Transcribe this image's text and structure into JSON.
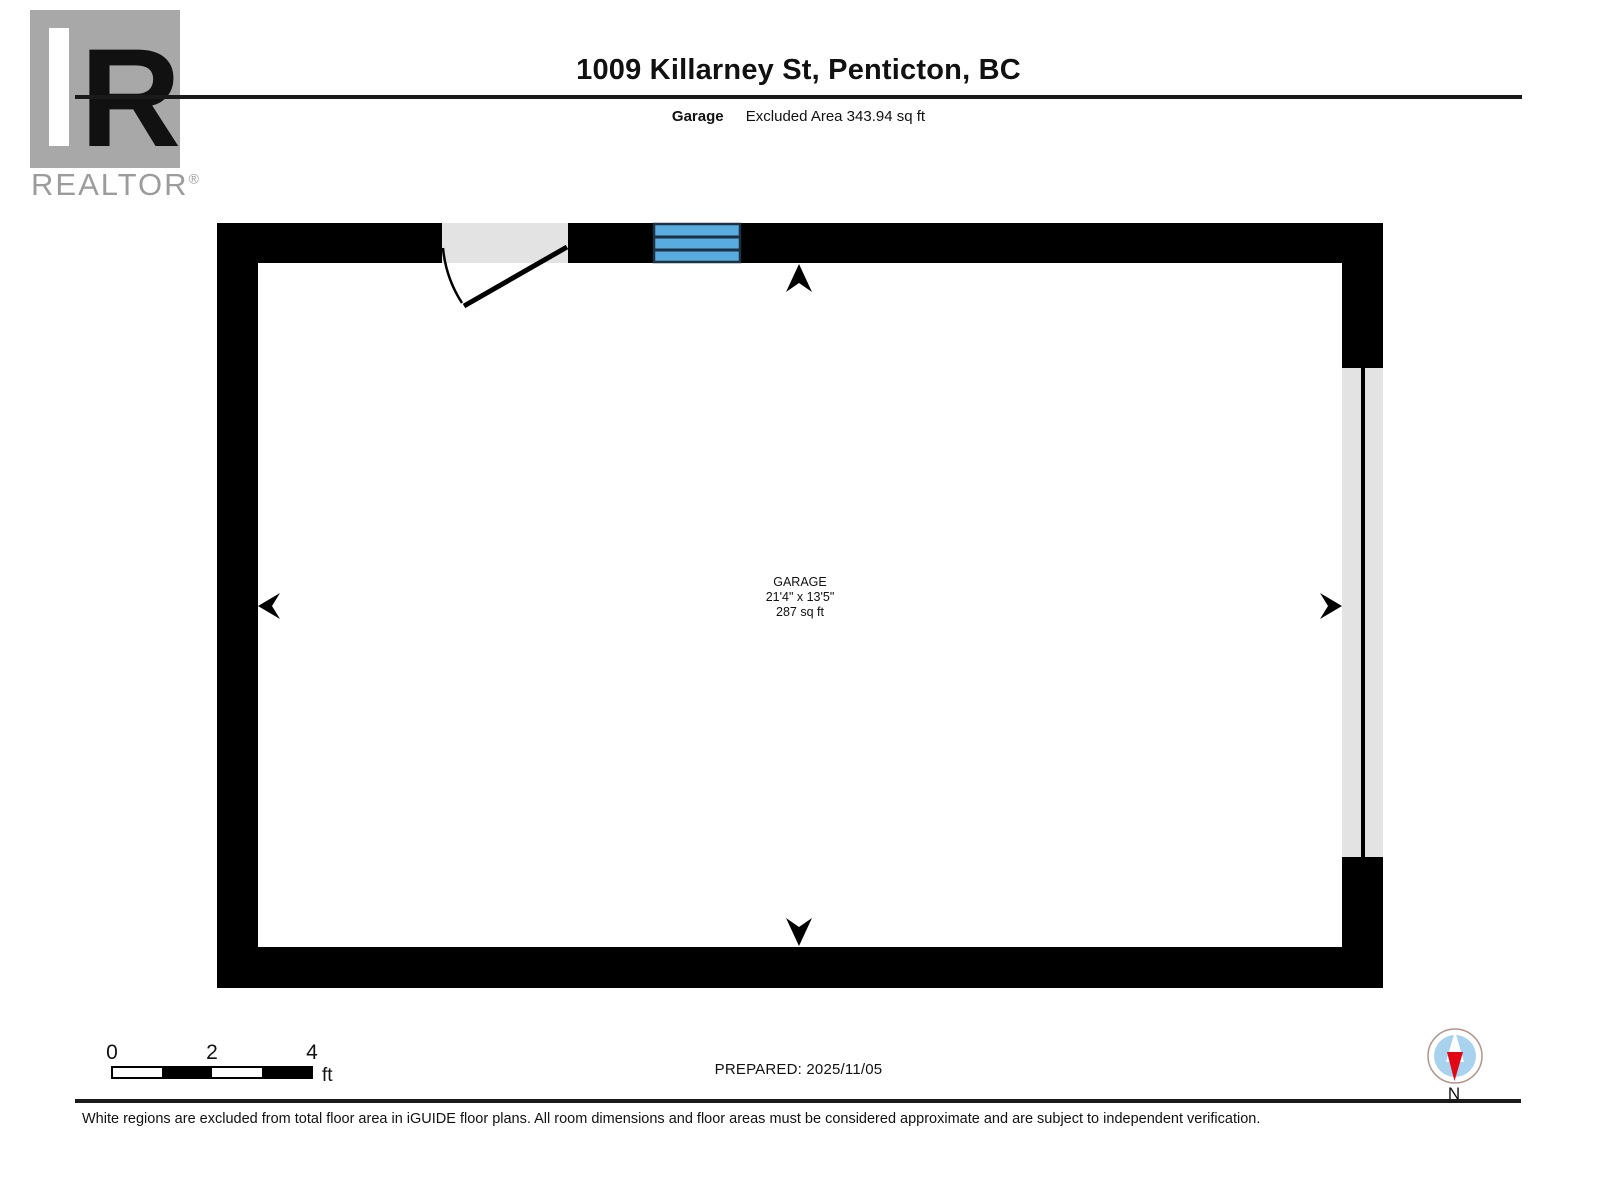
{
  "brand": {
    "logo_letter": "R",
    "logo_word": "REALTOR",
    "logo_reg": "®"
  },
  "header": {
    "title": "1009 Killarney St, Penticton, BC",
    "floor_label": "Garage",
    "area_label": "Excluded Area 343.94 sq ft"
  },
  "plan": {
    "room": {
      "name": "GARAGE",
      "dimensions": "21'4\" x 13'5\"",
      "area": "287 sq ft"
    },
    "features": [
      "door-swing",
      "window",
      "garage-door-opening",
      "dimension-arrows"
    ]
  },
  "colors": {
    "wall": "#000000",
    "opening_gray": "#e3e3e3",
    "window_blue": "#58ace0",
    "window_frame": "#1d3143",
    "logo_gray": "#a8a8a8",
    "logo_text_gray": "#9c9c9c",
    "compass_ring": "#b3948b",
    "compass_blue": "#a9d2ef",
    "compass_red": "#e30613"
  },
  "footer": {
    "scale_ticks": [
      "0",
      "2",
      "4"
    ],
    "scale_unit": "ft",
    "prepared": "PREPARED: 2025/11/05",
    "compass_label": "N",
    "disclaimer": "White regions are excluded from total floor area in iGUIDE floor plans. All room dimensions and floor areas must be considered approximate and are subject to independent verification."
  }
}
